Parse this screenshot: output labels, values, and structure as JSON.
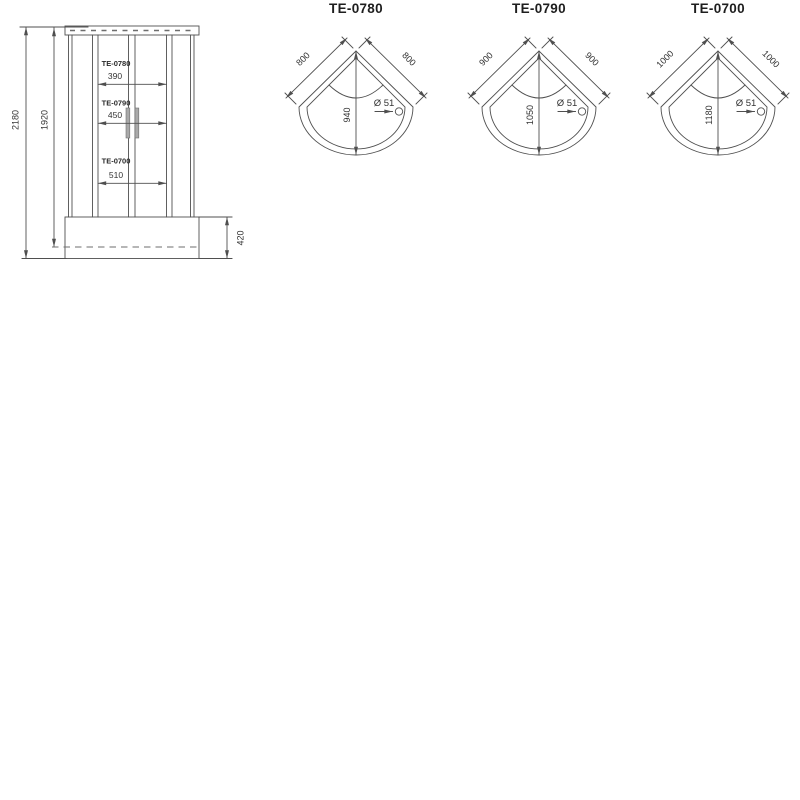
{
  "colors": {
    "line": "#4f4f4f",
    "text": "#333333",
    "handle_fill": "#a9a9a9"
  },
  "elevation": {
    "overall_height": "2180",
    "frame_height": "1920",
    "tray_height": "420",
    "rows": [
      {
        "model": "TE-0780",
        "door_width": "390"
      },
      {
        "model": "TE-0790",
        "door_width": "450"
      },
      {
        "model": "TE-0700",
        "door_width": "510"
      }
    ]
  },
  "trays": [
    {
      "model": "TE-0780",
      "side": "800",
      "depth": "940",
      "drain": "Ø 51"
    },
    {
      "model": "TE-0790",
      "side": "900",
      "depth": "1050",
      "drain": "Ø 51"
    },
    {
      "model": "TE-0700",
      "side": "1000",
      "depth": "1180",
      "drain": "Ø 51"
    }
  ]
}
